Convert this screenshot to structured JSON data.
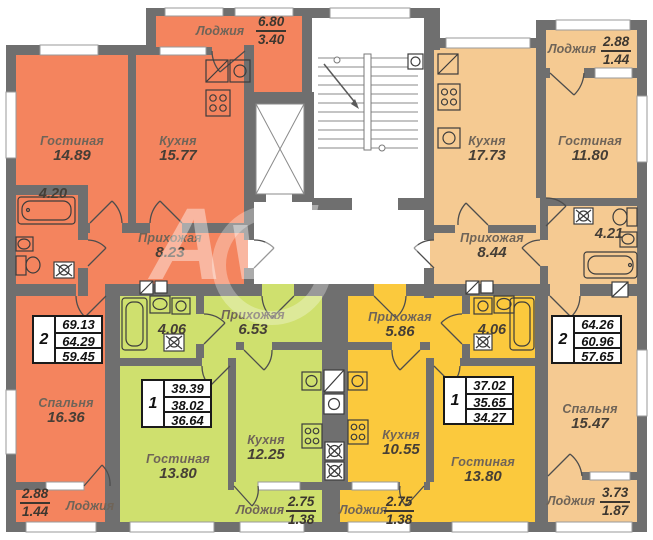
{
  "watermark": "Avito",
  "colors": {
    "left_apartment": "#f4845e",
    "right_apartment": "#f5ca92",
    "green_apartment": "#cfe06e",
    "yellow_apartment": "#fbc93d",
    "walls": "#6f6f6f"
  },
  "apartments": {
    "left": {
      "rooms_count": "2",
      "area_total": "69.13",
      "area_no_balcony": "64.29",
      "area_living": "59.45",
      "living": {
        "name": "Гостиная",
        "area": "14.89"
      },
      "kitchen": {
        "name": "Кухня",
        "area": "15.77"
      },
      "hall": {
        "name": "Прихожая",
        "area": "8.23"
      },
      "bath": {
        "area": "4.20"
      },
      "bedroom": {
        "name": "Спальня",
        "area": "16.36"
      },
      "loggia_top": {
        "name": "Лоджия",
        "full": "6.80",
        "reduced": "3.40"
      },
      "loggia_bottom": {
        "name": "Лоджия",
        "full": "2.88",
        "reduced": "1.44"
      }
    },
    "right": {
      "rooms_count": "2",
      "area_total": "64.26",
      "area_no_balcony": "60.96",
      "area_living": "57.65",
      "living": {
        "name": "Гостиная",
        "area": "11.80"
      },
      "kitchen": {
        "name": "Кухня",
        "area": "17.73"
      },
      "hall": {
        "name": "Прихожая",
        "area": "8.44"
      },
      "bath": {
        "area": "4.21"
      },
      "bedroom": {
        "name": "Спальня",
        "area": "15.47"
      },
      "loggia_top": {
        "name": "Лоджия",
        "full": "2.88",
        "reduced": "1.44"
      },
      "loggia_bottom": {
        "name": "Лоджия",
        "full": "3.73",
        "reduced": "1.87"
      }
    },
    "green": {
      "rooms_count": "1",
      "area_total": "39.39",
      "area_no_balcony": "38.02",
      "area_living": "36.64",
      "living": {
        "name": "Гостиная",
        "area": "13.80"
      },
      "kitchen": {
        "name": "Кухня",
        "area": "12.25"
      },
      "hall": {
        "name": "Прихожая",
        "area": "6.53"
      },
      "bath": {
        "area": "4.06"
      },
      "loggia": {
        "name": "Лоджия",
        "full": "2.75",
        "reduced": "1.38"
      }
    },
    "yellow": {
      "rooms_count": "1",
      "area_total": "37.02",
      "area_no_balcony": "35.65",
      "area_living": "34.27",
      "living": {
        "name": "Гостиная",
        "area": "13.80"
      },
      "kitchen": {
        "name": "Кухня",
        "area": "10.55"
      },
      "hall": {
        "name": "Прихожая",
        "area": "5.86"
      },
      "bath": {
        "area": "4.06"
      },
      "loggia": {
        "name": "Лоджия",
        "full": "2.75",
        "reduced": "1.38"
      }
    }
  }
}
